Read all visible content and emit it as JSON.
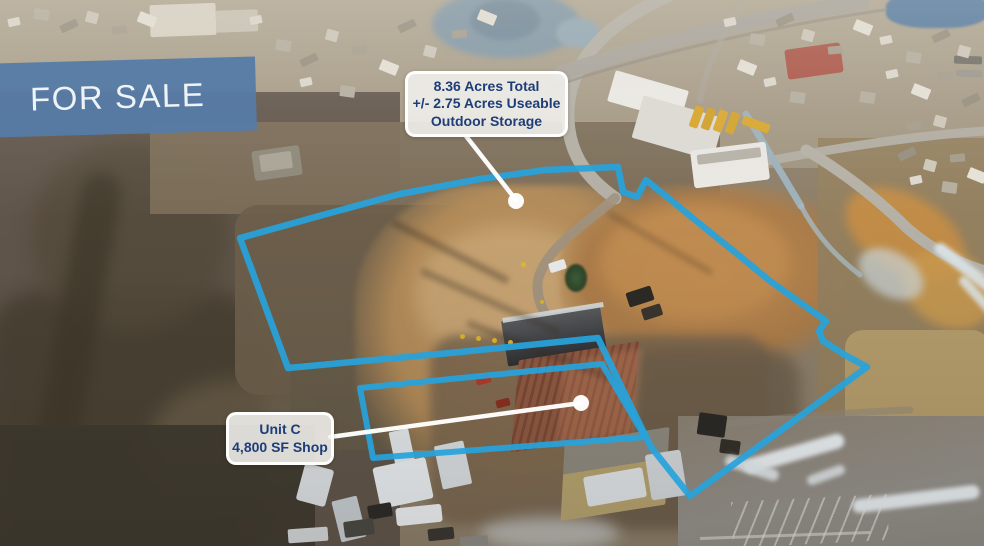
{
  "banner": {
    "label": "FOR SALE"
  },
  "callouts": {
    "acreage": {
      "line1": "8.36 Acres Total",
      "line2": "+/- 2.75 Acres Useable",
      "line3": "Outdoor Storage"
    },
    "unit_c": {
      "line1": "Unit C",
      "line2": "4,800 SF Shop"
    }
  },
  "colors": {
    "boundary_outline": "#27A2DC",
    "banner_background": "#567BA7",
    "callout_text": "#1E3D78",
    "leader_line": "#FFFFFF"
  }
}
